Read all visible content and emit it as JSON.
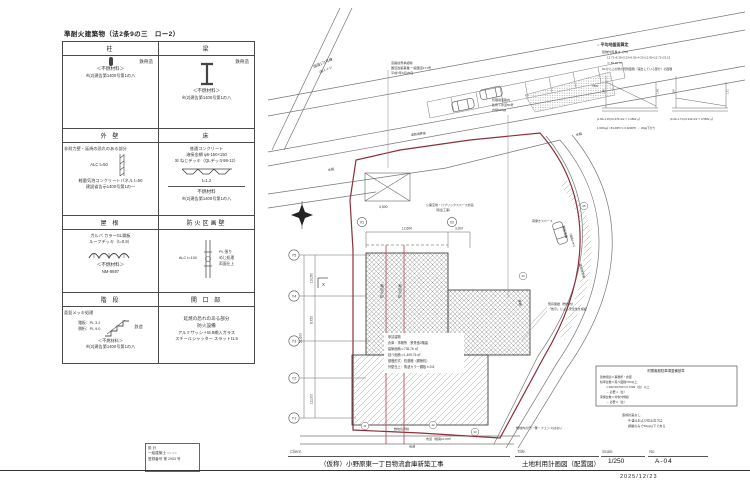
{
  "doc": {
    "labels": {
      "client": "Client.",
      "title": "Title.",
      "scale": "Scale.",
      "no": "No."
    },
    "project": "（仮称）小野原東一丁目物流倉庫新築工事",
    "drawing_title": "土地利用計画図（配置図）",
    "scale": "1/250",
    "drawing_no": "A-04",
    "date": "2025/12/23"
  },
  "designer_box": {
    "line1": "設 計",
    "line2": "一級建築士 ○○ ○○",
    "line3": "登録番号 第 2953 号"
  },
  "fire_table": {
    "title": "準耐火建築物（法2条9の三　ロー2）",
    "headers": {
      "h1l": "柱",
      "h1r": "梁",
      "h2l": "外 壁",
      "h2r": "床",
      "h3l": "屋 根",
      "h3r": "防火区画壁",
      "h4l": "階 段",
      "h4r": "開 口 部"
    },
    "column": {
      "structure": "鉄骨造",
      "material": "＜不燃材料＞",
      "code": "※(2)建告第1400号第1の八"
    },
    "beam": {
      "structure": "鉄骨造",
      "material": "＜不燃材料＞",
      "code": "※(2)建告第1400号第1の八"
    },
    "wall": {
      "heading": "非耐力壁・延焼の恐れのある部分",
      "sketch_label": "ALC t=50",
      "line1": "軽量気泡コンクリートパネル t=50",
      "line2": "建設省告示1400号第1の一"
    },
    "floor": {
      "line1": "普通コンクリート",
      "line2": "溶接金網 φ6-150×150",
      "line3": "☒ ねじデッキ（QLデッキ98-12）",
      "line4": "t=1.2",
      "material": "不燃材料",
      "code": "※(2)建告第1400号第1の八"
    },
    "roof": {
      "line1": "ガルバ カラーGL鋼板",
      "line2": "ルーフデッキ（t=0.8）",
      "material": "＜不燃材料＞",
      "cert": "NM-8697"
    },
    "partition": {
      "left_label": "ALC t=100",
      "r1": "PL 張り",
      "r2": "めじ処理",
      "r3": "両面仕上"
    },
    "stairs": {
      "line0": "亜鉛メッキ処理",
      "line1": "踏板：PL 3.2",
      "line2": "側桁：PL 9.0",
      "tag": "鉄造",
      "material": "＜不燃材料＞",
      "code": "※(2)建告第1400号第1の八"
    },
    "opening": {
      "line1": "延焼の恐れのある部分",
      "line2": "防火設備",
      "line3": "アルミサッシ＋t6.8網入ガラス",
      "line4": "スチールシャッター スラットt1.5"
    }
  },
  "plan": {
    "colors": {
      "boundary": "#8c2e3c",
      "section_line": "#c03a4a",
      "line": "#555"
    },
    "road_main": "国道171号線",
    "road_main_sub": "（国メ-1-1）",
    "waterway": "水路",
    "sidewalk": "歩道",
    "city_road": "市道（幅員10.0ｍ）",
    "driveway": "車路",
    "note_top": [
      "道路境界承認線",
      "国道改築事業 一般国道171号",
      "平成7年6月26日"
    ],
    "note_sewer": [
      "管理用道路内",
      "私有下水道50号",
      "内径600㎜"
    ],
    "note_public": [
      "公開空地・パブリックスペース計画",
      "（別途工事）"
    ],
    "boundary_road": "道路境界線",
    "boundary_adj": "隣地境界線",
    "boundary_site": "敷地境界線",
    "dev_road": "開発道路",
    "dev_road_w": "（幅員6.0ｍ）",
    "note_wall": [
      "既存擁壁（敷地内）",
      "「告示」による安全性を検証"
    ],
    "note_fence": "敷地内の門・塀・フェンスはない",
    "loading": "荷捌きスペース",
    "section_x": "X",
    "fire_line": "防火区画",
    "building_text": [
      "申請建物",
      "倉庫・事務所　鉄骨造2階建",
      "建築面積＝735.76 ㎡",
      "延べ面積＝1,405.76 ㎡",
      "基礎形式：杭基礎（鋼管杭）",
      "外壁仕上：角波カラー鋼板 t=0.8"
    ],
    "dims": {
      "top1": "12,600",
      "top2": "3,200",
      "left1": "13,050",
      "left2": "9,720",
      "left_total": "51,600",
      "left3": "12,000",
      "park": "4,500"
    },
    "grid_y": [
      "Y5",
      "Y4",
      "Y3",
      "Y2",
      "Y1"
    ],
    "grid_x": [
      "X1",
      "X2"
    ],
    "pts": [
      "21",
      "22",
      "23",
      "24",
      "25"
    ],
    "avg": {
      "title": "○ 平均地盤面算定",
      "l1": "建物外周長さ（ｍ）",
      "l2": "12.72+6.35+5.23+6.92+4.23+12.90+12.72+23.15",
      "l3": "＝ 83.00 ｍ",
      "l4": "GLから上の壁の見附面積（露出している部分）の面積",
      "tbm": "T.B.M",
      "d1a": "1.60",
      "d1b": "1.45",
      "d2a": "0.34",
      "d2b": "1.71",
      "c1": "(1.60+1.45)×0.276×1/2 ≒ 1.0862 ㎡",
      "c2": "(0.34+1.71)×0.344×1/2 ≒ 0.5832 ㎡",
      "c3": "1.6454㎡ / 83.00ｍ ≒ 0.0200ｍ　∴ 20㎜下がり"
    },
    "parking_box": {
      "title": "附置義務駐車場整備基準",
      "l1": "建物用途＝事務所・倉庫",
      "l2": "駐車台数＝延べ面積/700以上",
      "l3": "＝490.66/700＝0.7009〔台〕以上",
      "l4": "→ 必要 1〔台〕",
      "l5": "荷捌台数＝対象外規模",
      "l6": "→ 必要 0〔台〕"
    },
    "grading": [
      "造成計画なし",
      "※ 盛土および切土高さは",
      "調整のみで50㎝以下である"
    ]
  }
}
